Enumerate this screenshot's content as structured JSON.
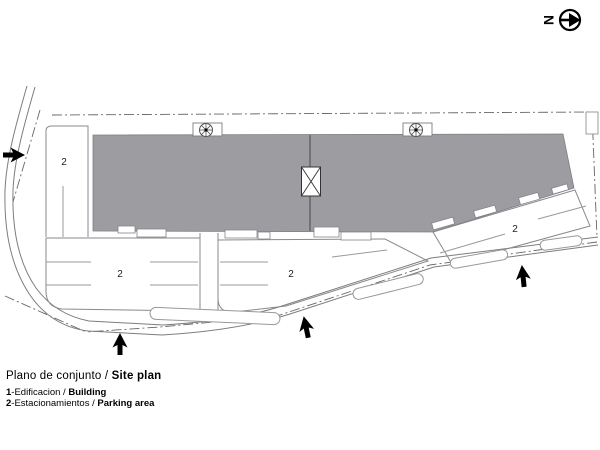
{
  "north": {
    "letter": "N"
  },
  "labels": {
    "parking": "2"
  },
  "legend": {
    "title": {
      "normal": "Plano de conjunto / ",
      "bold": "Site plan"
    },
    "items": [
      {
        "num": "1",
        "text": "-Edificacion / ",
        "bold": "Building"
      },
      {
        "num": "2",
        "text": "-Estacionamientos / ",
        "bold": "Parking area"
      }
    ]
  },
  "colors": {
    "building_fill": "#9c9ca1",
    "building_stroke": "#7e7e83",
    "lot_line": "#8a8a8e",
    "boundary_line": "#666666",
    "ink": "#000000"
  }
}
